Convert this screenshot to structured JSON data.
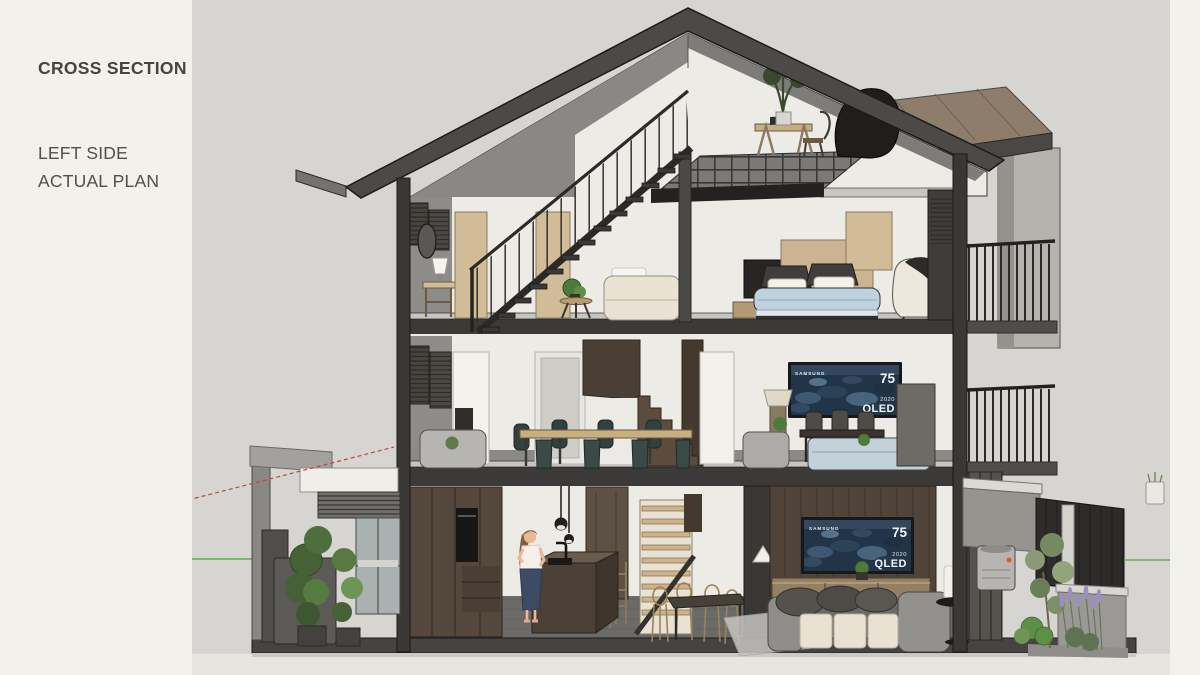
{
  "panel": {
    "title": "CROSS SECTION",
    "subtitle_line1": "LEFT SIDE",
    "subtitle_line2": "ACTUAL PLAN"
  },
  "tvs": {
    "level2": {
      "brand": "SAMSUNG",
      "size": "75",
      "year": "2020",
      "model": "QLED"
    },
    "ground": {
      "brand": "SAMSUNG",
      "size": "75",
      "year": "2020",
      "model": "QLED"
    }
  },
  "colors": {
    "bg_left": "#f3f1eb",
    "bg_render": "#d7d5d2",
    "bg_ground": "#e7e5df",
    "title_text": "#454440",
    "subtitle_text": "#504f4a",
    "roof": "#4c4a47",
    "roof_shingle": "#8d7d6a",
    "wall_interior": "#edebe5",
    "wall_shade": "#8e8c89",
    "slab": "#3b3a38",
    "slab_top": "#c7c5c1",
    "wood_door": "#d2bc97",
    "wood_console": "#937f63",
    "wood_dark": "#50443a",
    "cabinet": "#54483d",
    "metal": "#2b2a29",
    "tv_frame": "#16181b",
    "tv_screen": "#223448",
    "bed_blue": "#bfd3de",
    "sofa_cream": "#e9e2d2",
    "sofa_gray": "#8f8d89",
    "plant": "#4e7a3c",
    "plant_dark": "#456135",
    "lavender": "#9a8fc4",
    "fence": "#2e2c2a",
    "axis_red": "#c2453a",
    "axis_green": "#58b347"
  }
}
